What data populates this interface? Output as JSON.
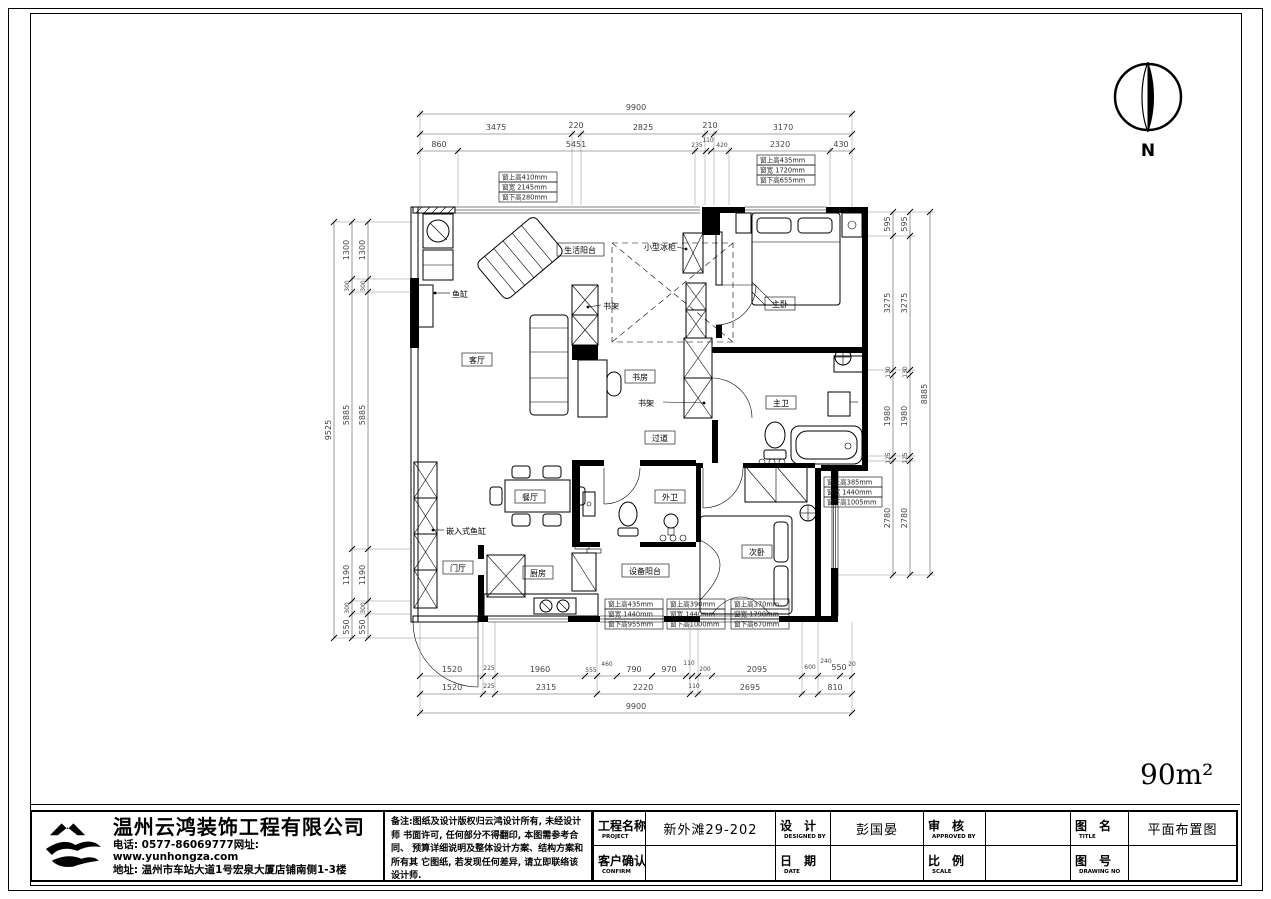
{
  "page": {
    "area": "90m²",
    "north": "N"
  },
  "plan": {
    "rooms": [
      "生活阳台",
      "客厅",
      "书房",
      "过道",
      "主卧",
      "主卫",
      "餐厅",
      "门厅",
      "厨房",
      "外卫",
      "设备阳台",
      "次卧"
    ],
    "leaders": [
      "小型冰柜",
      "鱼缸",
      "书架",
      "书架",
      "嵌入式鱼缸"
    ],
    "win_notes": [
      {
        "t": "窗上高410mm",
        "m": "窗宽 2145mm",
        "b": "窗下高280mm"
      },
      {
        "t": "窗上高435mm",
        "m": "窗宽 1720mm",
        "b": "窗下高655mm"
      },
      {
        "t": "窗上高385mm",
        "m": "窗宽 1440mm",
        "b": "窗下高1005mm"
      },
      {
        "t": "窗上高435mm",
        "m": "窗宽 1440mm",
        "b": "窗下高955mm"
      },
      {
        "t": "窗上高390mm",
        "m": "窗宽 1440mm",
        "b": "窗下高1000mm"
      },
      {
        "t": "窗上高370mm",
        "m": "窗宽 1790mm",
        "b": "窗下高670mm"
      }
    ]
  },
  "dims": {
    "top_total": "9900",
    "top_row2": [
      "3475",
      "220",
      "2825",
      "210",
      "3170"
    ],
    "top_row3": [
      "860",
      "5451",
      "235",
      "110",
      "420",
      "2320",
      "430"
    ],
    "bottom_row1": [
      "1520",
      "225",
      "1960",
      "555",
      "460",
      "790",
      "970",
      "110",
      "200",
      "2095",
      "600",
      "240",
      "550",
      "20"
    ],
    "bottom_row2": [
      "1520",
      "225",
      "2315",
      "2220",
      "110",
      "2695",
      "810"
    ],
    "bottom_total": "9900",
    "left_total": "9525",
    "left_chain": [
      "1300",
      "300",
      "5885",
      "1190",
      "300",
      "550"
    ],
    "right_total": "8885",
    "right_chain": [
      "595",
      "3275",
      "130",
      "1980",
      "125",
      "2780"
    ]
  },
  "title_block": {
    "company": {
      "name": "温州云鸿装饰工程有限公司",
      "phone": "电话: 0577-86069777网址: www.yunhongza.com",
      "address": "地址: 温州市车站大道1号宏泉大厦店铺南侧1-3楼"
    },
    "notes": [
      "备注:图纸及设计版权归云鸿设计所有, 未经设计师",
      "书面许可, 任何部分不得翻印, 本图需参考合同、",
      "预算详细说明及整体设计方案、结构方案和所有其",
      "它图纸, 若发现任何差异, 请立即联络该设计师."
    ],
    "fields": {
      "project": {
        "zh": "工程名称",
        "en": "PROJECT",
        "value": "新外滩29-202"
      },
      "confirm": {
        "zh": "客户确认",
        "en": "CONFIRM",
        "value": ""
      },
      "design": {
        "zh": "设　计",
        "en": "DESIGNED BY",
        "value": "彭国晏"
      },
      "date": {
        "zh": "日　期",
        "en": "DATE",
        "value": ""
      },
      "approve": {
        "zh": "审　核",
        "en": "APPROVED BY",
        "value": ""
      },
      "scale": {
        "zh": "比　例",
        "en": "SCALE",
        "value": ""
      },
      "title": {
        "zh": "图　名",
        "en": "TITLE",
        "value": "平面布置图"
      },
      "dwg": {
        "zh": "图　号",
        "en": "DRAWING NO",
        "value": ""
      }
    }
  }
}
